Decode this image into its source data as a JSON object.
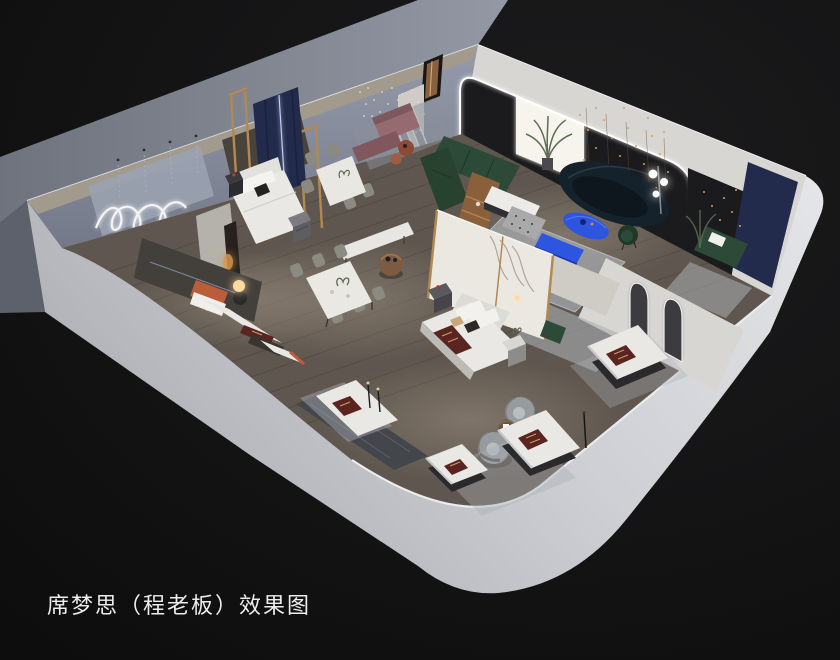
{
  "caption": {
    "text": "席梦思（程老板）效果图"
  },
  "scene": {
    "objects": [
      "exterior-wall",
      "interior-floor",
      "led-arch-portal",
      "feature-wall-string-lights",
      "picture-window",
      "navy-wall-panel",
      "green-sectional-sofa",
      "navy-curved-sofa",
      "blue-coffee-table",
      "blue-console-bench",
      "patterned-ottoman",
      "globe-floor-lamp",
      "palm-plant",
      "master-bed",
      "marble-headboard-wall",
      "nightstand",
      "dining-table-six-chairs",
      "dining-table-four-chairs",
      "round-side-table",
      "gold-frame-partition",
      "navy-drape-panel",
      "squiggle-neon-light",
      "bead-chandelier",
      "mauve-sofa-set",
      "terracotta-bed",
      "glow-orb-lamp",
      "arched-mirror-partition",
      "pill-mirror-pillar",
      "mattress-display",
      "brand-runner",
      "barrel-swivel-chairs",
      "area-rug",
      "white-bench",
      "marble-walkway",
      "slim-floor-lamp"
    ]
  },
  "palette": {
    "background": "#131313",
    "caption_text": "#ededee",
    "exterior_band": "#848994",
    "interior_wall": "#8a90a1",
    "wall_trim_beige": "#a29a8c",
    "floor_wood": "#5f574f",
    "rug": "#aaaeb4",
    "arch_wall": "#d8d6d2",
    "feature_wall": "#1b1b1d",
    "navy_panel": "#232b4c",
    "window_light": "#f6f4ec",
    "led_white": "#ffffff",
    "sofa_green": "#2d4a38",
    "sofa_navy_teal": "#15222b",
    "accent_blue": "#2d55e0",
    "accent_blue_deep": "#1b34b4",
    "runner_maroon": "#5a2420",
    "brass_gold": "#b08a52",
    "marble_white": "#ebe8e2",
    "mattress_white": "#e9e8e5",
    "terracotta": "#bb5c3a",
    "mauve": "#966b70",
    "chair_olive": "#8a8a80",
    "chair_gray": "#969c9e",
    "wood_walnut": "#8a5f3c",
    "string_light_amber": "#d3a06a",
    "lamp_warm_glow": "#ffd9a2",
    "base_dark": "#2a2a2c"
  }
}
